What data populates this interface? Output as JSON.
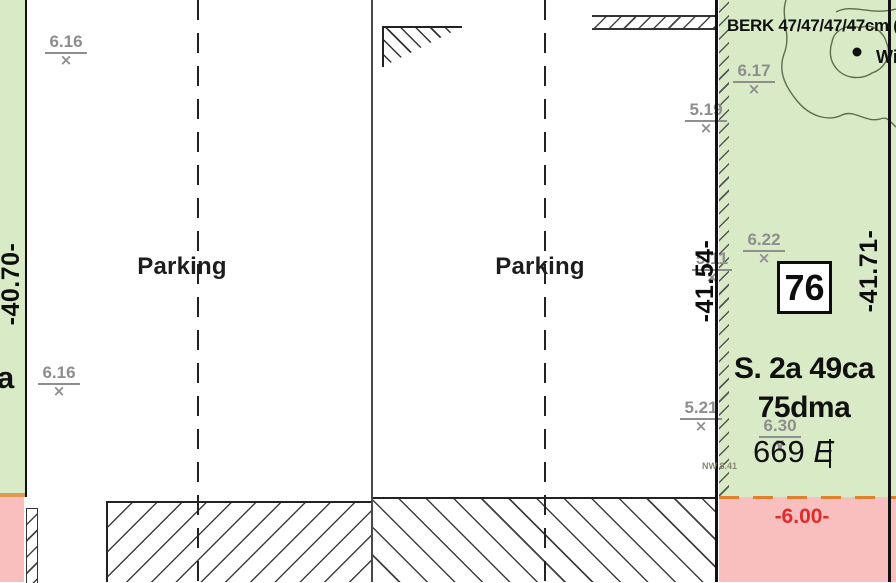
{
  "colors": {
    "green": "#d9ebc6",
    "pink": "#f9bfbf",
    "orange_divider": "#dd9a50",
    "orange_dash": "#e0802f",
    "red_text": "#e02b2b",
    "gray_marker": "#8e8e8e",
    "line": "#111111",
    "tree": "#5b6e4e"
  },
  "labels": {
    "parking_left": "Parking",
    "parking_right": "Parking",
    "dim_left": "-40.70-",
    "dim_mid": "-41.54-",
    "dim_right": "-41.71-",
    "parcel_number": "76",
    "area_size": "S. 2a 49ca",
    "area_dma": "75dma",
    "address_number": "669",
    "address_suffix": "E",
    "tree_note": "BERK 47/47/47/47cm (",
    "tree_note_right": "Wi",
    "small_note": "NW 8.41",
    "level": "-6.00-",
    "corner_letter": "a"
  },
  "elevation_markers": [
    {
      "value": "6.16",
      "x": 66,
      "y": 33,
      "symbol": "x"
    },
    {
      "value": "6.16",
      "x": 59,
      "y": 364,
      "symbol": "x"
    },
    {
      "value": "6.17",
      "x": 754,
      "y": 62,
      "symbol": "x"
    },
    {
      "value": "5.19",
      "x": 706,
      "y": 101,
      "symbol": "x"
    },
    {
      "value": "5.11",
      "x": 712,
      "y": 250,
      "symbol": "x"
    },
    {
      "value": "6.22",
      "x": 764,
      "y": 231,
      "symbol": "x"
    },
    {
      "value": "5.21",
      "x": 701,
      "y": 399,
      "symbol": "x"
    },
    {
      "value": "6.30",
      "x": 780,
      "y": 417,
      "symbol": "v"
    }
  ]
}
